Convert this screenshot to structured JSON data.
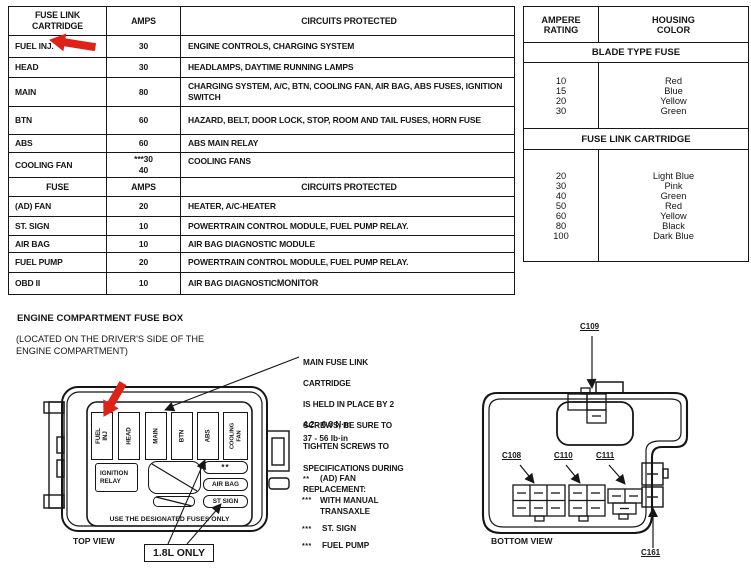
{
  "left_table": {
    "header1": {
      "col1": "FUSE LINK\nCARTRIDGE",
      "col2": "AMPS",
      "col3": "CIRCUITS PROTECTED"
    },
    "rows1": [
      {
        "name": "FUEL INJ.",
        "amps": "30",
        "circuits": "ENGINE CONTROLS, CHARGING SYSTEM"
      },
      {
        "name": "HEAD",
        "amps": "30",
        "circuits": "HEADLAMPS, DAYTIME RUNNING LAMPS"
      },
      {
        "name": "MAIN",
        "amps": "80",
        "circuits": "CHARGING SYSTEM, A/C, BTN, COOLING FAN, AIR BAG, ABS FUSES, IGNITION SWITCH"
      },
      {
        "name": "BTN",
        "amps": "60",
        "circuits": "HAZARD, BELT, DOOR LOCK, STOP, ROOM AND TAIL FUSES, HORN FUSE"
      },
      {
        "name": "ABS",
        "amps": "60",
        "circuits": "ABS MAIN RELAY"
      },
      {
        "name": "COOLING FAN",
        "amps": "***30",
        "amps2": "40",
        "circuits": "COOLING FANS"
      }
    ],
    "header2": {
      "col1": "FUSE",
      "col2": "AMPS",
      "col3": "CIRCUITS PROTECTED"
    },
    "rows2": [
      {
        "name": "(AD) FAN",
        "amps": "20",
        "circuits": "HEATER, A/C-HEATER"
      },
      {
        "name": "ST. SIGN",
        "amps": "10",
        "circuits": "POWERTRAIN CONTROL MODULE, FUEL PUMP RELAY."
      },
      {
        "name": "AIR BAG",
        "amps": "10",
        "circuits": "AIR BAG DIAGNOSTIC MODULE"
      },
      {
        "name": "FUEL PUMP",
        "amps": "20",
        "circuits": "POWERTRAIN CONTROL MODULE, FUEL PUMP RELAY."
      },
      {
        "name": "OBD II",
        "amps": "10",
        "circuits": "AIR BAG DIAGNOSTIC ",
        "circuits_bold": "MONITOR"
      }
    ]
  },
  "right_table": {
    "header": {
      "col1": "AMPERE\nRATING",
      "col2": "HOUSING\nCOLOR"
    },
    "band1": "BLADE TYPE FUSE",
    "blade_amps": [
      "10",
      "15",
      "20",
      "30"
    ],
    "blade_colors": [
      "Red",
      "Blue",
      "Yellow",
      "Green"
    ],
    "band2": "FUSE LINK CARTRIDGE",
    "cartridge_amps": [
      "20",
      "30",
      "40",
      "50",
      "60",
      "80",
      "100"
    ],
    "cartridge_colors": [
      "Light Blue",
      "Pink",
      "Green",
      "Red",
      "Yellow",
      "Black",
      "Dark Blue"
    ]
  },
  "section": {
    "title": "ENGINE COMPARTMENT FUSE BOX",
    "subtitle": "(LOCATED ON THE DRIVER'S SIDE OF THE\nENGINE COMPARTMENT)"
  },
  "topview": {
    "slots": [
      "FUEL INJ",
      "HEAD",
      "MAIN",
      "BTN",
      "ABS",
      "COOLING\nFAN"
    ],
    "ignition_relay": "IGNITION\nRELAY",
    "dots_box": "**",
    "air_bag": "AIR BAG",
    "st_sign": "ST SIGN",
    "designated": "USE THE DESIGNATED FUSES ONLY",
    "caption": "TOP VIEW",
    "callout_18l": "1.8L ONLY"
  },
  "note": {
    "lines": [
      "MAIN FUSE LINK",
      "CARTRIDGE",
      "IS HELD IN PLACE BY 2",
      "SCREWS; BE SURE TO",
      "TIGHTEN SCREWS TO",
      "SPECIFICATIONS DURING",
      "REPLACEMENT:"
    ],
    "torque1": "4.2 - 6.3 N·m",
    "torque2": "37 - 56 lb·in"
  },
  "legend": {
    "items": [
      {
        "marker": "**",
        "label": "(AD) FAN"
      },
      {
        "marker": "***",
        "label": "WITH MANUAL\nTRANSAXLE"
      },
      {
        "marker": "***",
        "label": "ST. SIGN"
      },
      {
        "marker": "***",
        "label": "FUEL PUMP"
      }
    ]
  },
  "bottomview": {
    "caption": "BOTTOM VIEW",
    "c109": "C109",
    "c108": "C108",
    "c110": "C110",
    "c111": "C111",
    "c161": "C161"
  },
  "colors": {
    "arrow_red": "#df2217",
    "ink": "#161616"
  }
}
